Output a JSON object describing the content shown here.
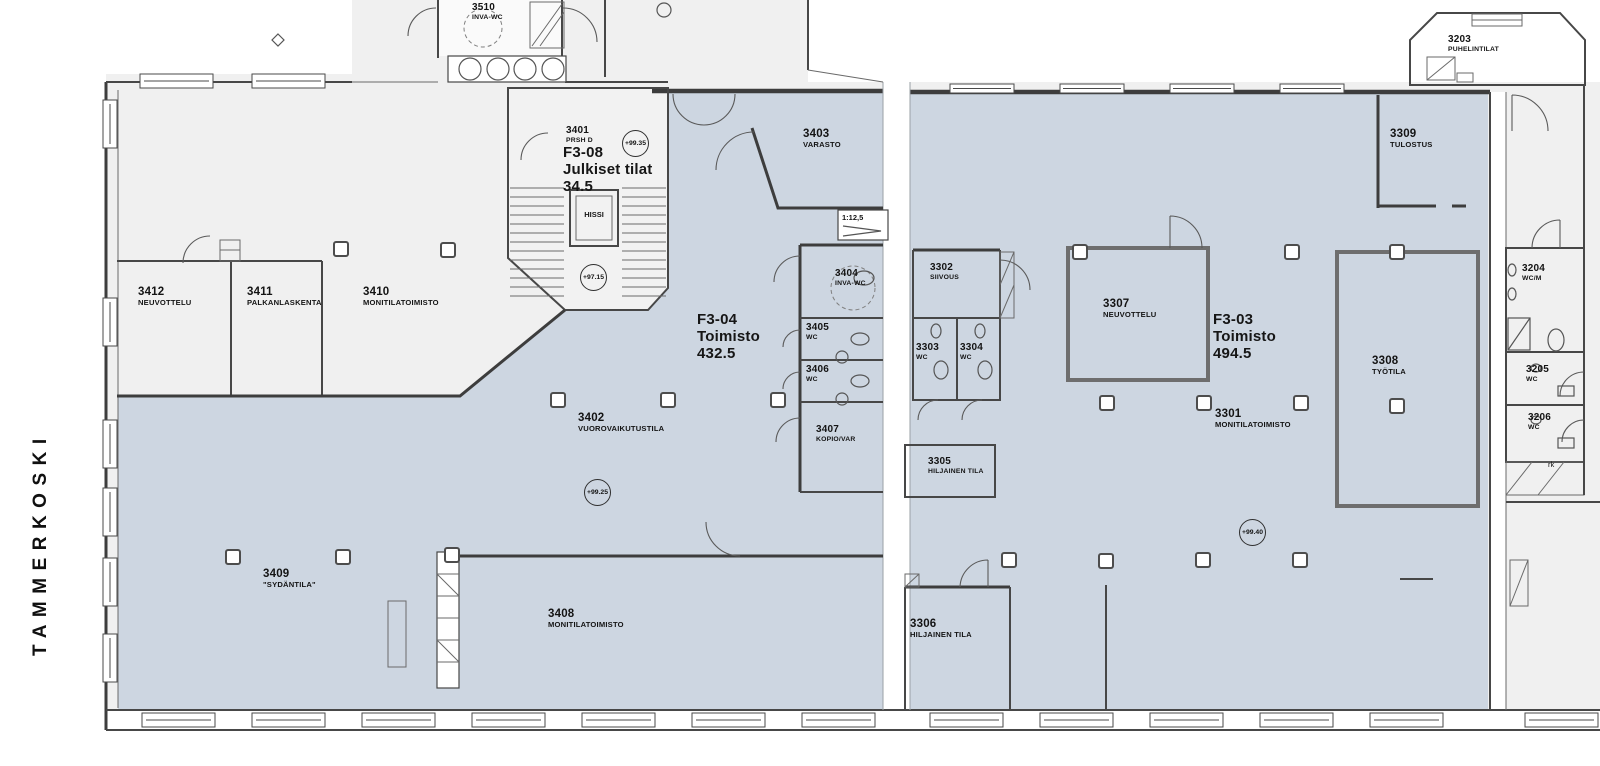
{
  "site": {
    "waterfront_label": "TAMMERKOSKI"
  },
  "zones": {
    "f3_08": {
      "code": "F3-08",
      "name": "Julkiset tilat",
      "area": "34.5"
    },
    "f3_04": {
      "code": "F3-04",
      "name": "Toimisto",
      "area": "432.5"
    },
    "f3_03": {
      "code": "F3-03",
      "name": "Toimisto",
      "area": "494.5"
    }
  },
  "rooms": {
    "r3510": {
      "number": "3510",
      "name": "INVA-WC"
    },
    "r3401": {
      "number": "3401",
      "name": "PRSH D"
    },
    "r3403": {
      "number": "3403",
      "name": "VARASTO"
    },
    "r3412": {
      "number": "3412",
      "name": "NEUVOTTELU"
    },
    "r3411": {
      "number": "3411",
      "name": "PALKANLASKENTA"
    },
    "r3410": {
      "number": "3410",
      "name": "MONITILATOIMISTO"
    },
    "r3404": {
      "number": "3404",
      "name": "INVA-WC"
    },
    "r3405": {
      "number": "3405",
      "name": "WC"
    },
    "r3406": {
      "number": "3406",
      "name": "WC"
    },
    "r3407": {
      "number": "3407",
      "name": "KOPIO/VAR"
    },
    "r3402": {
      "number": "3402",
      "name": "VUOROVAIKUTUSTILA"
    },
    "r3409": {
      "number": "3409",
      "name": "\"SYDÄNTILA\""
    },
    "r3408": {
      "number": "3408",
      "name": "MONITILATOIMISTO"
    },
    "r3302": {
      "number": "3302",
      "name": "SIIVOUS"
    },
    "r3303": {
      "number": "3303",
      "name": "WC"
    },
    "r3304": {
      "number": "3304",
      "name": "WC"
    },
    "r3305": {
      "number": "3305",
      "name": "HILJAINEN TILA"
    },
    "r3306": {
      "number": "3306",
      "name": "HILJAINEN TILA"
    },
    "r3307": {
      "number": "3307",
      "name": "NEUVOTTELU"
    },
    "r3301": {
      "number": "3301",
      "name": "MONITILATOIMISTO"
    },
    "r3308": {
      "number": "3308",
      "name": "TYÖTILA"
    },
    "r3309": {
      "number": "3309",
      "name": "TULOSTUS"
    },
    "r3203": {
      "number": "3203",
      "name": "PUHELINTILAT"
    },
    "r3204": {
      "number": "3204",
      "name": "WC/M"
    },
    "r3205": {
      "number": "3205",
      "name": "WC"
    },
    "r3206": {
      "number": "3206",
      "name": "WC"
    }
  },
  "elevator_label": "HISSI",
  "levels": {
    "stair_upper": "+99.35",
    "stair_lower": "+97.15",
    "f3_04_floor": "+99.25",
    "f3_03_floor": "+99.40"
  },
  "ramp_slope": "1:12,5",
  "misc": {
    "rk": "rk"
  },
  "colors": {
    "highlight_fill": "#cdd6e1",
    "plain_fill": "#f0f0f0",
    "wall": "#474747"
  }
}
